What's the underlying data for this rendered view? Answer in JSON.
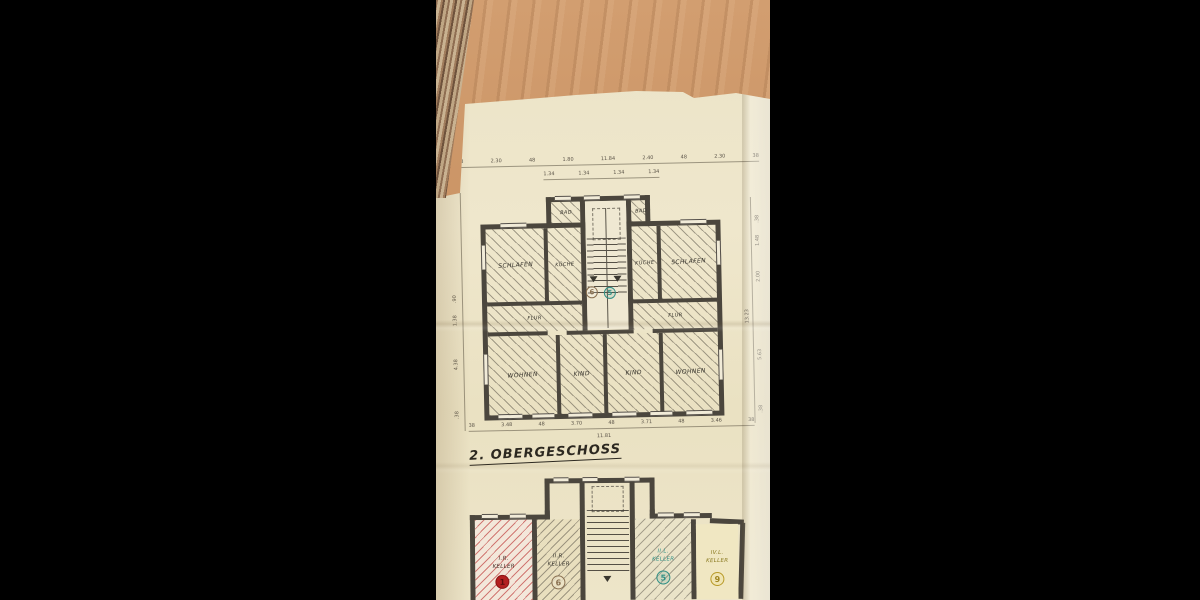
{
  "colors": {
    "paper": "#ece4c8",
    "wood": "#c99263",
    "ink": "#4b463d",
    "red_unit": "#b32020",
    "sepia_unit": "#8a7050",
    "teal_unit": "#2f8f85",
    "yellow_unit": "#b89a28"
  },
  "title": "2. OBERGESCHOSS",
  "upper_plan": {
    "rooms": {
      "schlafen_left": "SCHLAFEN",
      "kueche_left": "KÜCHE",
      "bad_left": "BAD",
      "bad_right": "BAD",
      "kueche_right": "KÜCHE",
      "schlafen_right": "SCHLAFEN",
      "flur_left": "FLUR",
      "flur_right": "FLUR",
      "wohnen_left": "WOHNEN",
      "kind_left": "KIND",
      "kind_right": "KIND",
      "wohnen_right": "WOHNEN"
    },
    "units": {
      "left_number": "6",
      "right_number": "5"
    },
    "dims_top": [
      "38",
      "2.30",
      "48",
      "1.80",
      "11.84",
      "2.40",
      "48",
      "2.30",
      "38"
    ],
    "dims_top2": [
      "1.34",
      "1.34",
      "1.34",
      "1.34"
    ],
    "dims_bottom": [
      "38",
      "3.48",
      "48",
      "3.70",
      "48",
      "3.71",
      "48",
      "3.46",
      "38"
    ],
    "dims_bottom_total": "11.81",
    "dims_left": [
      ".90",
      "1.38",
      "4.38",
      ".38"
    ],
    "dims_right": [
      ".38",
      "1.48",
      "2.00",
      "13.23",
      "5.63",
      ".38"
    ]
  },
  "lower_plan": {
    "rooms": [
      {
        "line1": "I.R.",
        "line2": "KELLER",
        "number": "1"
      },
      {
        "line1": "II.R.",
        "line2": "KELLER",
        "number": "6"
      },
      {
        "line1": "II.L.",
        "line2": "KELLER",
        "number": "5"
      },
      {
        "line1": "IV.L.",
        "line2": "KELLER",
        "number": "9"
      }
    ]
  }
}
